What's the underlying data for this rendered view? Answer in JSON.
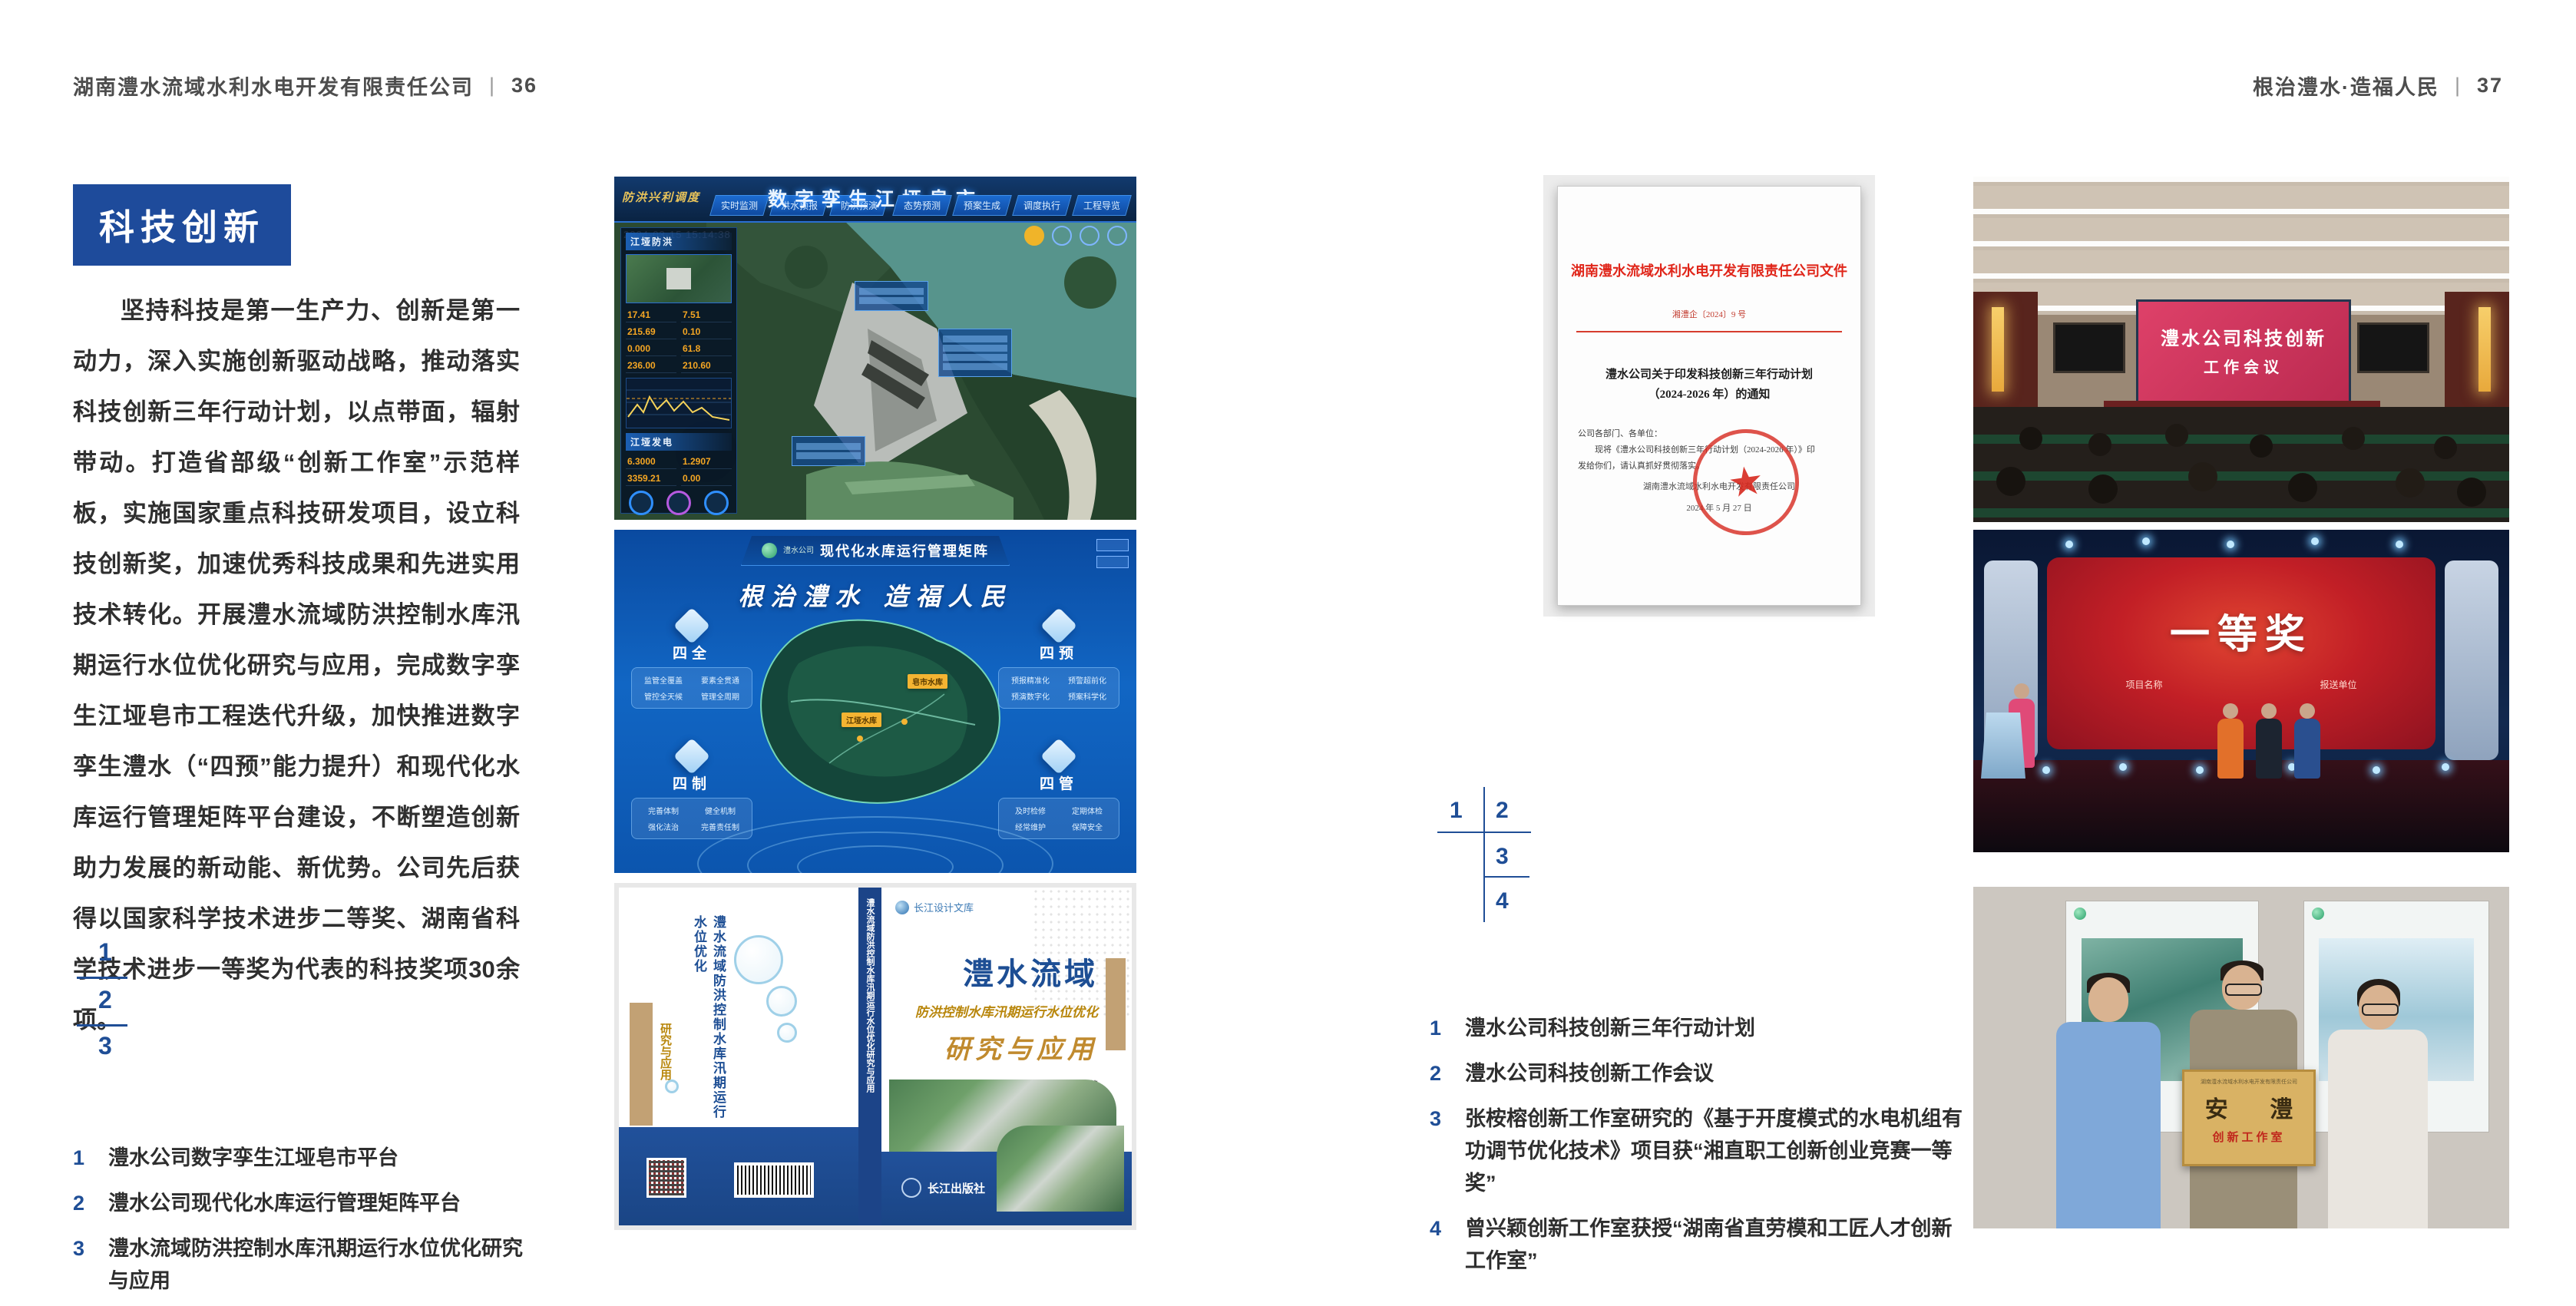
{
  "page_left": {
    "header": {
      "company": "湖南澧水流域水利水电开发有限责任公司",
      "divider": "|",
      "page_number": "36"
    },
    "section_title": "科技创新",
    "paragraph": "坚持科技是第一生产力、创新是第一动力，深入实施创新驱动战略，推动落实科技创新三年行动计划，以点带面，辐射带动。打造省部级“创新工作室”示范样板，实施国家重点科技研发项目，设立科技创新奖，加速优秀科技成果和先进实用技术转化。开展澧水流域防洪控制水库汛期运行水位优化研究与应用，完成数字孪生江垭皂市工程迭代升级，加快推进数字孪生澧水（“四预”能力提升）和现代化水库运行管理矩阵平台建设，不断塑造创新助力发展的新动能、新优势。公司先后获得以国家科学技术进步二等奖、湖南省科学技术进步一等奖为代表的科技奖项30余项。",
    "figure_nums": [
      "1",
      "2",
      "3"
    ],
    "captions": [
      {
        "num": "1",
        "text": "澧水公司数字孪生江垭皂市平台"
      },
      {
        "num": "2",
        "text": "澧水公司现代化水库运行管理矩阵平台"
      },
      {
        "num": "3",
        "text": "澧水流域防洪控制水库汛期运行水位优化研究与应用"
      }
    ],
    "fig1": {
      "corner_label": "防洪兴利调度",
      "tabs_left": [
        "实时监测",
        "洪水预报",
        "防洪预演"
      ],
      "title": "数字孪生江垭皂市",
      "tabs_right": [
        "态势预测",
        "预案生成",
        "调度执行",
        "工程导览"
      ],
      "timestamp": "2024-03-15 15:14:38",
      "panel_flood": "江垭防洪",
      "flood_stats": [
        "17.41",
        "7.51",
        "215.69",
        "0.10",
        "0.000",
        "61.8",
        "236.00",
        "210.60"
      ],
      "panel_power": "江垭发电",
      "power_stats": [
        "6.3000",
        "1.2907",
        "3359.21",
        "0.00"
      ]
    },
    "fig2": {
      "logo_text": "澧水公司",
      "header": "现代化水库运行管理矩阵",
      "slogan": "根治澧水 造福人民",
      "map_labels": [
        "皂市水库",
        "江垭水库"
      ],
      "groups": [
        {
          "title": "四全",
          "items": [
            "监管全覆盖",
            "要素全贯通",
            "管控全天候",
            "管理全周期"
          ]
        },
        {
          "title": "四预",
          "items": [
            "预报精准化",
            "预警超前化",
            "预演数字化",
            "预案科学化"
          ]
        },
        {
          "title": "四制",
          "items": [
            "完善体制",
            "健全机制",
            "强化法治",
            "完善责任制"
          ]
        },
        {
          "title": "四管",
          "items": [
            "及时检修",
            "定期体检",
            "经常维护",
            "保障安全"
          ]
        }
      ]
    },
    "fig3": {
      "series": "长江设计文库",
      "title1": "澧水流域",
      "title2": "防洪控制水库汛期运行水位优化",
      "title3": "研究与应用",
      "authors": "洪兴骏  沈坤民  鲁军  刘世军  等著",
      "publisher": "长江出版社",
      "spine_text": "澧水流域防洪控制水库汛期运行水位优化研究与应用",
      "back_title": "澧水流域防洪控制水库汛期运行水位优化",
      "back_subtitle": "研究与应用"
    }
  },
  "page_right": {
    "header": {
      "slogan": "根治澧水·造福人民",
      "divider": "|",
      "page_number": "37"
    },
    "document": {
      "title": "湖南澧水流域水利水电开发有限责任公司文件",
      "doc_no": "湘澧企〔2024〕9 号",
      "subject_line1": "澧水公司关于印发科技创新三年行动计划",
      "subject_line2": "（2024-2026 年）的通知",
      "salutation": "公司各部门、各单位：",
      "body_line1": "现将《澧水公司科技创新三年行动计划（2024-2026 年）》印",
      "body_line2": "发给你们，请认真抓好贯彻落实。",
      "signature": "湖南澧水流域水利水电开发有限责任公司",
      "date": "2024 年 5 月 27 日"
    },
    "figure_nums": [
      "1",
      "2",
      "3",
      "4"
    ],
    "captions": [
      {
        "num": "1",
        "text": "澧水公司科技创新三年行动计划"
      },
      {
        "num": "2",
        "text": "澧水公司科技创新工作会议"
      },
      {
        "num": "3",
        "text": "张桉榕创新工作室研究的《基于开度模式的水电机组有功调节优化技术》项目获“湘直职工创新创业竞赛一等奖”"
      },
      {
        "num": "4",
        "text": "曾兴颖创新工作室获授“湖南省直劳模和工匠人才创新工作室”"
      }
    ],
    "photo1": {
      "screen_line1": "澧水公司科技创新",
      "screen_line2": "工作会议"
    },
    "photo2": {
      "award": "一等奖",
      "col1": "项目名称",
      "col2": "报送单位"
    },
    "photo3": {
      "plaque_header": "湖南澧水流域水利水电开发有限责任公司",
      "plaque_main": "安 澧",
      "plaque_sub": "创新工作室"
    }
  },
  "colors": {
    "accent_blue": "#1e4b9b",
    "caption_number_blue": "#1f4e96",
    "doc_red": "#d6281e",
    "header_gray": "#4d4d4d"
  }
}
